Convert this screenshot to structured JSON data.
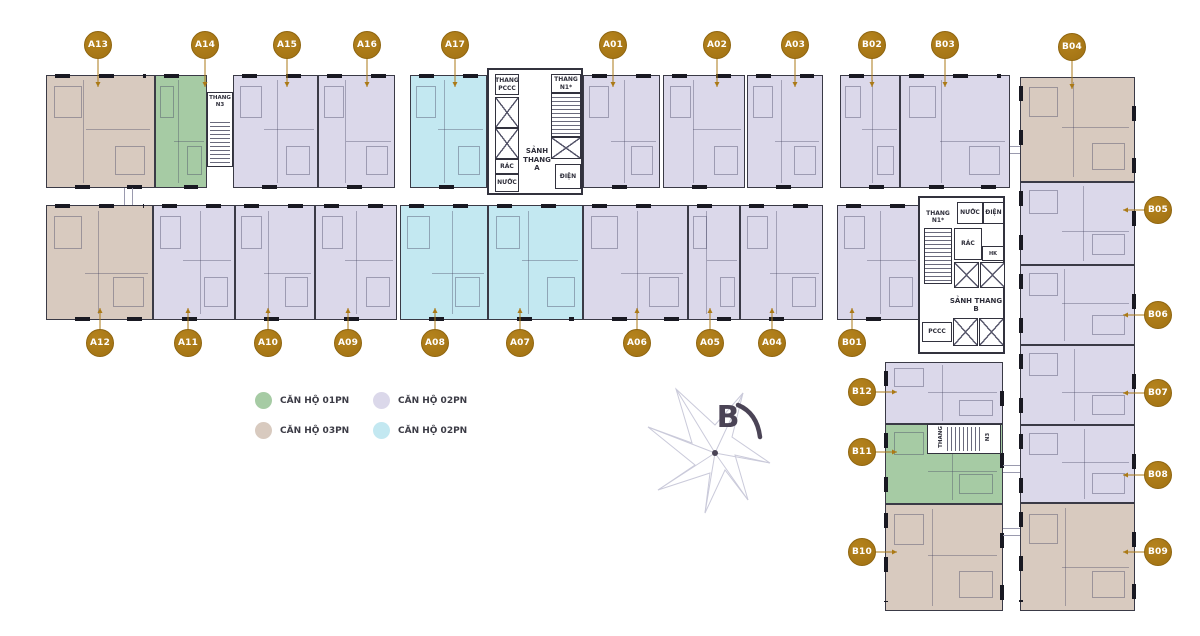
{
  "palette": {
    "gold": "#ab7a17",
    "wall": "#3a3a46",
    "core_line": "#32323e",
    "compass_dark": "#4b4456",
    "web_stroke": "#cacada"
  },
  "unit_types": {
    "1pn": {
      "label": "CĂN HỘ 01PN",
      "color": "#a6cba4"
    },
    "2pn": {
      "label": "CĂN HỘ 02PN",
      "color": "#dbd8ea"
    },
    "3pn": {
      "label": "CĂN HỘ 03PN",
      "color": "#d8cabf"
    },
    "2pn_b": {
      "label": "CĂN HỘ 02PN",
      "color": "#c3e8f1"
    }
  },
  "legend": {
    "items": [
      {
        "type": "1pn",
        "label": "CĂN HỘ 01PN",
        "color": "#a6cba4"
      },
      {
        "type": "2pn",
        "label": "CĂN HỘ 02PN",
        "color": "#dbd8ea"
      },
      {
        "type": "3pn",
        "label": "CĂN HỘ 03PN",
        "color": "#d8cabf"
      },
      {
        "type": "2pn_b",
        "label": "CĂN HỘ 02PN",
        "color": "#c3e8f1"
      }
    ]
  },
  "compass": {
    "label": "B"
  },
  "cores": {
    "core_a": {
      "pccc_shaft": "THANG PCCC",
      "stair": "THANG N1*",
      "lobby": "SẢNH THANG A",
      "trash": "RÁC",
      "water": "NƯỚC",
      "power": "ĐIỆN"
    },
    "core_b": {
      "stair": "THANG N1*",
      "water": "NƯỚC",
      "power": "ĐIỆN",
      "trash": "RÁC",
      "hk": "HK",
      "lobby": "SẢNH THANG B",
      "pccc": "PCCC"
    },
    "stair_a": "THANG N3",
    "stair_b_1": "THANG",
    "stair_b_2": "N3"
  },
  "units": [
    {
      "id": "A13",
      "type": "3pn",
      "rect": [
        46,
        75,
        109,
        113
      ],
      "label_xy": [
        98,
        45
      ],
      "side": "top",
      "orient": "h"
    },
    {
      "id": "A14",
      "type": "1pn",
      "rect": [
        155,
        75,
        52,
        113
      ],
      "label_xy": [
        205,
        45
      ],
      "side": "top",
      "orient": "h"
    },
    {
      "id": "A15",
      "type": "2pn",
      "rect": [
        233,
        75,
        85,
        113
      ],
      "label_xy": [
        287,
        45
      ],
      "side": "top",
      "orient": "h"
    },
    {
      "id": "A16",
      "type": "2pn",
      "rect": [
        318,
        75,
        77,
        113
      ],
      "label_xy": [
        367,
        45
      ],
      "side": "top",
      "orient": "h"
    },
    {
      "id": "A17",
      "type": "2pn_b",
      "rect": [
        410,
        75,
        77,
        113
      ],
      "label_xy": [
        455,
        45
      ],
      "side": "top",
      "orient": "h"
    },
    {
      "id": "A01",
      "type": "2pn",
      "rect": [
        583,
        75,
        77,
        113
      ],
      "label_xy": [
        613,
        45
      ],
      "side": "top",
      "orient": "h"
    },
    {
      "id": "A02",
      "type": "2pn",
      "rect": [
        663,
        75,
        82,
        113
      ],
      "label_xy": [
        717,
        45
      ],
      "side": "top",
      "orient": "h"
    },
    {
      "id": "A03",
      "type": "2pn",
      "rect": [
        747,
        75,
        76,
        113
      ],
      "label_xy": [
        795,
        45
      ],
      "side": "top",
      "orient": "h"
    },
    {
      "id": "B02",
      "type": "2pn",
      "rect": [
        840,
        75,
        60,
        113
      ],
      "label_xy": [
        872,
        45
      ],
      "side": "top",
      "orient": "h"
    },
    {
      "id": "B03",
      "type": "2pn",
      "rect": [
        900,
        75,
        110,
        113
      ],
      "label_xy": [
        945,
        45
      ],
      "side": "top",
      "orient": "h"
    },
    {
      "id": "B04",
      "type": "3pn",
      "rect": [
        1020,
        77,
        115,
        105
      ],
      "label_xy": [
        1072,
        47
      ],
      "side": "top",
      "orient": "v"
    },
    {
      "id": "B05",
      "type": "2pn",
      "rect": [
        1020,
        182,
        115,
        83
      ],
      "label_xy": [
        1158,
        210
      ],
      "side": "right",
      "orient": "v"
    },
    {
      "id": "B06",
      "type": "2pn",
      "rect": [
        1020,
        265,
        115,
        80
      ],
      "label_xy": [
        1158,
        315
      ],
      "side": "right",
      "orient": "v"
    },
    {
      "id": "B07",
      "type": "2pn",
      "rect": [
        1020,
        345,
        115,
        80
      ],
      "label_xy": [
        1158,
        393
      ],
      "side": "right",
      "orient": "v"
    },
    {
      "id": "B08",
      "type": "2pn",
      "rect": [
        1020,
        425,
        115,
        78
      ],
      "label_xy": [
        1158,
        475
      ],
      "side": "right",
      "orient": "v"
    },
    {
      "id": "B09",
      "type": "3pn",
      "rect": [
        1020,
        503,
        115,
        108
      ],
      "label_xy": [
        1158,
        552
      ],
      "side": "right",
      "orient": "v"
    },
    {
      "id": "B12",
      "type": "2pn",
      "rect": [
        885,
        362,
        118,
        62
      ],
      "label_xy": [
        862,
        392
      ],
      "side": "left",
      "orient": "v"
    },
    {
      "id": "B11",
      "type": "1pn",
      "rect": [
        885,
        424,
        118,
        80
      ],
      "label_xy": [
        862,
        452
      ],
      "side": "left",
      "orient": "v"
    },
    {
      "id": "B10",
      "type": "3pn",
      "rect": [
        885,
        504,
        118,
        107
      ],
      "label_xy": [
        862,
        552
      ],
      "side": "left",
      "orient": "v"
    },
    {
      "id": "A12",
      "type": "3pn",
      "rect": [
        46,
        205,
        107,
        115
      ],
      "label_xy": [
        100,
        343
      ],
      "side": "bottom",
      "orient": "h"
    },
    {
      "id": "A11",
      "type": "2pn",
      "rect": [
        153,
        205,
        82,
        115
      ],
      "label_xy": [
        188,
        343
      ],
      "side": "bottom",
      "orient": "h"
    },
    {
      "id": "A10",
      "type": "2pn",
      "rect": [
        235,
        205,
        80,
        115
      ],
      "label_xy": [
        268,
        343
      ],
      "side": "bottom",
      "orient": "h"
    },
    {
      "id": "A09",
      "type": "2pn",
      "rect": [
        315,
        205,
        82,
        115
      ],
      "label_xy": [
        348,
        343
      ],
      "side": "bottom",
      "orient": "h"
    },
    {
      "id": "A08",
      "type": "2pn_b",
      "rect": [
        400,
        205,
        88,
        115
      ],
      "label_xy": [
        435,
        343
      ],
      "side": "bottom",
      "orient": "h"
    },
    {
      "id": "A07",
      "type": "2pn_b",
      "rect": [
        488,
        205,
        95,
        115
      ],
      "label_xy": [
        520,
        343
      ],
      "side": "bottom",
      "orient": "h"
    },
    {
      "id": "A06",
      "type": "2pn",
      "rect": [
        583,
        205,
        105,
        115
      ],
      "label_xy": [
        637,
        343
      ],
      "side": "bottom",
      "orient": "h"
    },
    {
      "id": "A05",
      "type": "2pn",
      "rect": [
        688,
        205,
        52,
        115
      ],
      "label_xy": [
        710,
        343
      ],
      "side": "bottom",
      "orient": "h"
    },
    {
      "id": "A04",
      "type": "2pn",
      "rect": [
        740,
        205,
        83,
        115
      ],
      "label_xy": [
        772,
        343
      ],
      "side": "bottom",
      "orient": "h"
    },
    {
      "id": "B01",
      "type": "2pn",
      "rect": [
        837,
        205,
        83,
        115
      ],
      "label_xy": [
        852,
        343
      ],
      "side": "bottom",
      "orient": "h"
    }
  ]
}
